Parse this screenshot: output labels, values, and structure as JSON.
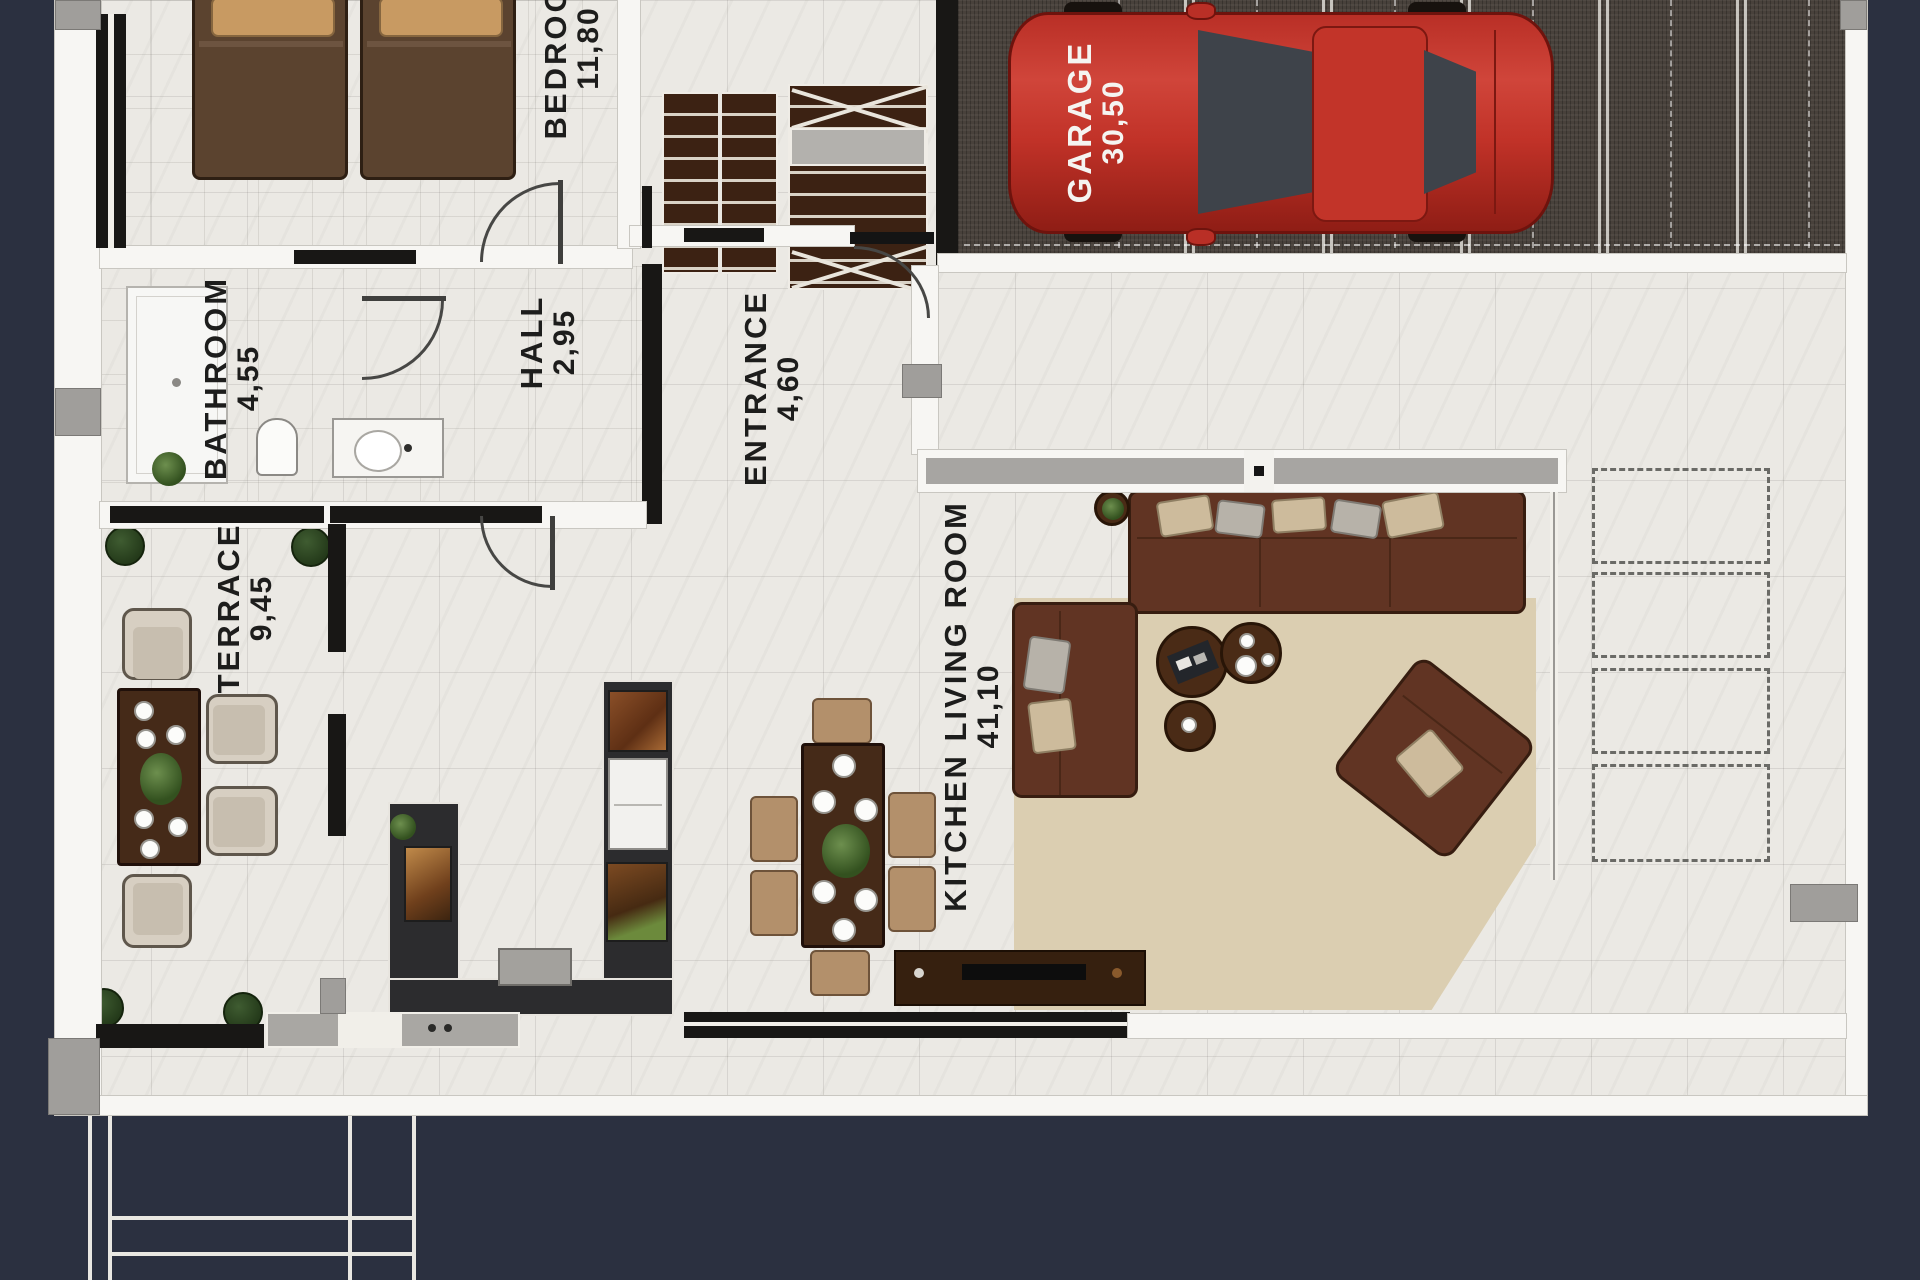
{
  "plan_title": "ground floor plan",
  "rooms": {
    "bedroom": {
      "name": "BEDROOM",
      "area": "11,80"
    },
    "garage": {
      "name": "GARAGE",
      "area": "30,50"
    },
    "bathroom": {
      "name": "BATHROOM",
      "area": "4,55"
    },
    "hall": {
      "name": "HALL",
      "area": "2,95"
    },
    "entrance": {
      "name": "ENTRANCE",
      "area": "4,60"
    },
    "terrace": {
      "name": "TERRACE",
      "area": "9,45"
    },
    "kitchen_living_room": {
      "name": "KITCHEN LIVING ROOM",
      "area": "41,10"
    }
  },
  "colors": {
    "background_navy": "#2b3040",
    "floor_tile": "#ebe9e4",
    "wall_white": "#f7f6f3",
    "wall_black": "#181715",
    "pillar_gray": "#a09e9b",
    "garage_floor": "#48413b",
    "car_red": "#c13228",
    "sofa_brown": "#613423",
    "wood_dark": "#452a18",
    "rug_beige": "#dbceb1",
    "counter_charcoal": "#2c2c2e",
    "bush_green": "#243a1a",
    "label_text": "#1d1d1c",
    "garage_label_text": "#f5f4f1"
  }
}
